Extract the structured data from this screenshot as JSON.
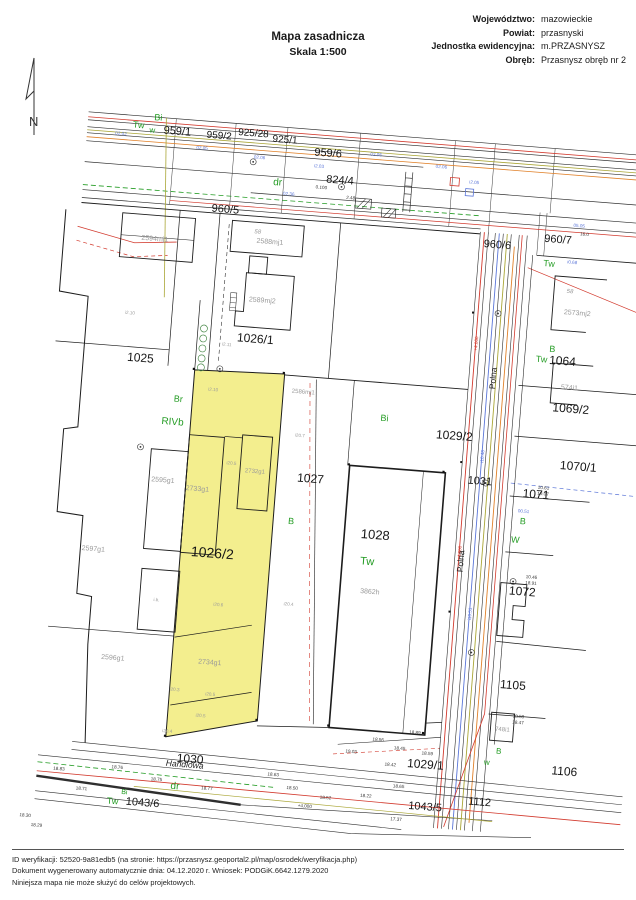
{
  "header": {
    "title": "Mapa zasadnicza",
    "scale": "Skala 1:500"
  },
  "meta": {
    "rows": [
      {
        "label": "Województwo:",
        "value": "mazowieckie"
      },
      {
        "label": "Powiat:",
        "value": "przasnyski"
      },
      {
        "label": "Jednostka ewidencyjna:",
        "value": "m.PRZASNYSZ"
      },
      {
        "label": "Obręb:",
        "value": "Przasnysz obręb nr 2"
      }
    ]
  },
  "compass": {
    "label": "N"
  },
  "footer": {
    "lines": [
      "ID weryfikacji: 52520-9a81edb5 (na stronie: https://przasnysz.geoportal2.pl/map/osrodek/weryfikacja.php)",
      "Dokument wygenerowany automatycznie dnia: 04.12.2020 r.   Wniosek: PODGiK.6642.1279.2020",
      "Niniejsza mapa nie może służyć do celów projektowych."
    ]
  },
  "map": {
    "colors": {
      "highlight": "#f3ee8e",
      "green": "#249c24",
      "blue": "#5b76d8",
      "red": "#d23a2e",
      "orange": "#e0812a",
      "olive": "#aaa636",
      "gray": "#9a9a9a",
      "black": "#333333"
    },
    "parcel_labels": [
      {
        "t": "959/1",
        "x": 152,
        "y": 143,
        "s": 11
      },
      {
        "t": "959/2",
        "x": 194,
        "y": 144,
        "s": 10
      },
      {
        "t": "925/28",
        "x": 228,
        "y": 139,
        "s": 10
      },
      {
        "t": "925/1",
        "x": 260,
        "y": 143,
        "s": 10
      },
      {
        "t": "959/6",
        "x": 304,
        "y": 153,
        "s": 11
      },
      {
        "t": "824/4",
        "x": 318,
        "y": 179,
        "s": 11
      },
      {
        "t": "960/5",
        "x": 206,
        "y": 217,
        "s": 11
      },
      {
        "t": "960/6",
        "x": 480,
        "y": 231,
        "s": 11
      },
      {
        "t": "960/7",
        "x": 540,
        "y": 221,
        "s": 11
      },
      {
        "t": "1025",
        "x": 133,
        "y": 372,
        "s": 12
      },
      {
        "t": "1026/1",
        "x": 246,
        "y": 344,
        "s": 12
      },
      {
        "t": "1026/2",
        "x": 220,
        "y": 561,
        "s": 14
      },
      {
        "t": "1027",
        "x": 312,
        "y": 479,
        "s": 12
      },
      {
        "t": "1028",
        "x": 381,
        "y": 530,
        "s": 13
      },
      {
        "t": "1064",
        "x": 554,
        "y": 342,
        "s": 12
      },
      {
        "t": "1069/2",
        "x": 566,
        "y": 389,
        "s": 12
      },
      {
        "t": "1029/2",
        "x": 452,
        "y": 425,
        "s": 12
      },
      {
        "t": "1070/1",
        "x": 578,
        "y": 446,
        "s": 12
      },
      {
        "t": "1031",
        "x": 481,
        "y": 468,
        "s": 11
      },
      {
        "t": "1071",
        "x": 538,
        "y": 477,
        "s": 12
      },
      {
        "t": "1072",
        "x": 532,
        "y": 575,
        "s": 12
      },
      {
        "t": "1105",
        "x": 530,
        "y": 669,
        "s": 12
      },
      {
        "t": "1106",
        "x": 588,
        "y": 751,
        "s": 12
      },
      {
        "t": "1029/1",
        "x": 449,
        "y": 755,
        "s": 12
      },
      {
        "t": "1030",
        "x": 214,
        "y": 768,
        "s": 12
      },
      {
        "t": "1043/6",
        "x": 170,
        "y": 815,
        "s": 11
      },
      {
        "t": "1043/5",
        "x": 452,
        "y": 797,
        "s": 11
      },
      {
        "t": "1112",
        "x": 506,
        "y": 788,
        "s": 11
      }
    ],
    "landuse_labels": [
      {
        "t": "Bi",
        "x": 132,
        "y": 131
      },
      {
        "t": "Tw",
        "x": 113,
        "y": 140
      },
      {
        "t": "w",
        "x": 127,
        "y": 144,
        "s": 8
      },
      {
        "t": "dr",
        "x": 256,
        "y": 186,
        "s": 10
      },
      {
        "t": "Tw",
        "x": 533,
        "y": 246
      },
      {
        "t": "Br",
        "x": 174,
        "y": 410
      },
      {
        "t": "RIVb",
        "x": 170,
        "y": 433,
        "s": 10
      },
      {
        "t": "Bi",
        "x": 381,
        "y": 413
      },
      {
        "t": "B",
        "x": 296,
        "y": 523
      },
      {
        "t": "Tw",
        "x": 375,
        "y": 557,
        "s": 11
      },
      {
        "t": "B",
        "x": 543,
        "y": 331
      },
      {
        "t": "Tw",
        "x": 533,
        "y": 342
      },
      {
        "t": "B",
        "x": 527,
        "y": 505
      },
      {
        "t": "W",
        "x": 521,
        "y": 524
      },
      {
        "t": "B",
        "x": 521,
        "y": 736,
        "s": 8
      },
      {
        "t": "w",
        "x": 510,
        "y": 748,
        "s": 8
      },
      {
        "t": "dr",
        "x": 201,
        "y": 796,
        "s": 10
      },
      {
        "t": "Bi",
        "x": 151,
        "y": 806,
        "s": 7
      },
      {
        "t": "Tw",
        "x": 140,
        "y": 816
      }
    ],
    "building_labels": [
      {
        "t": "2594mj1",
        "x": 138,
        "y": 252
      },
      {
        "t": "2588mj1",
        "x": 253,
        "y": 246
      },
      {
        "t": "2589mj2",
        "x": 250,
        "y": 305
      },
      {
        "t": "2586mj1",
        "x": 298,
        "y": 393,
        "s": 6
      },
      {
        "t": "2595g1",
        "x": 165,
        "y": 492
      },
      {
        "t": "2733g1",
        "x": 200,
        "y": 498
      },
      {
        "t": "2732g1",
        "x": 256,
        "y": 476,
        "s": 6
      },
      {
        "t": "2597g1",
        "x": 101,
        "y": 566
      },
      {
        "t": "2596g1",
        "x": 129,
        "y": 673
      },
      {
        "t": "2734g1",
        "x": 226,
        "y": 670
      },
      {
        "t": "3862h",
        "x": 380,
        "y": 587
      },
      {
        "t": "2573mj2",
        "x": 565,
        "y": 293
      },
      {
        "t": "574i1",
        "x": 563,
        "y": 368
      },
      {
        "t": "748i1",
        "x": 523,
        "y": 714,
        "s": 6
      }
    ],
    "street_labels": [
      {
        "t": "Polna",
        "x": 489,
        "y": 362,
        "rot": -90,
        "s": 8.5
      },
      {
        "t": "Polna",
        "x": 471,
        "y": 547,
        "rot": -90,
        "s": 8.5
      },
      {
        "t": "Handlowa",
        "x": 209,
        "y": 774,
        "italic": true,
        "s": 8.5
      }
    ],
    "micro_labels": [
      {
        "t": "02.02",
        "x": 96,
        "y": 150,
        "c": "blue"
      },
      {
        "t": "02.05",
        "x": 178,
        "y": 158,
        "c": "blue"
      },
      {
        "t": "02.06",
        "x": 236,
        "y": 163,
        "c": "blue"
      },
      {
        "t": "i2.03",
        "x": 296,
        "y": 167,
        "c": "blue"
      },
      {
        "t": "02.05",
        "x": 352,
        "y": 151,
        "c": "blue"
      },
      {
        "t": "02.06",
        "x": 418,
        "y": 158,
        "c": "blue"
      },
      {
        "t": "i2.05",
        "x": 452,
        "y": 171,
        "c": "blue"
      },
      {
        "t": "05.05",
        "x": 560,
        "y": 206,
        "c": "blue"
      },
      {
        "t": "16.0",
        "x": 566,
        "y": 214,
        "c": "black"
      },
      {
        "t": "02.36",
        "x": 268,
        "y": 197,
        "c": "blue"
      },
      {
        "t": "2.48",
        "x": 330,
        "y": 196,
        "c": "black"
      },
      {
        "t": "0.100",
        "x": 300,
        "y": 188,
        "c": "black"
      },
      {
        "t": "i2.11",
        "x": 218,
        "y": 352,
        "c": "gray"
      },
      {
        "t": "i2.10",
        "x": 208,
        "y": 398,
        "c": "gray"
      },
      {
        "t": "i2.10",
        "x": 119,
        "y": 328,
        "c": "gray"
      },
      {
        "t": "i20.5",
        "x": 232,
        "y": 470,
        "c": "gray"
      },
      {
        "t": "i20.7",
        "x": 298,
        "y": 437,
        "c": "gray"
      },
      {
        "t": "i20.6",
        "x": 230,
        "y": 612,
        "c": "gray"
      },
      {
        "t": "i20.4",
        "x": 300,
        "y": 606,
        "c": "gray"
      },
      {
        "t": "i20.3",
        "x": 193,
        "y": 700,
        "c": "gray"
      },
      {
        "t": "i20.5",
        "x": 229,
        "y": 702,
        "c": "gray"
      },
      {
        "t": "i20.5",
        "x": 221,
        "y": 724,
        "c": "gray"
      },
      {
        "t": "i20.4",
        "x": 189,
        "y": 742,
        "c": "gray"
      },
      {
        "t": "i.b.",
        "x": 168,
        "y": 612,
        "c": "gray"
      },
      {
        "t": "58",
        "x": 240,
        "y": 237,
        "c": "gray",
        "italic": true,
        "s": 6
      },
      {
        "t": "58",
        "x": 556,
        "y": 272,
        "c": "gray",
        "italic": true,
        "s": 6
      },
      {
        "t": "i0.68",
        "x": 556,
        "y": 243,
        "c": "blue"
      },
      {
        "t": "00.51",
        "x": 527,
        "y": 495,
        "c": "blue"
      },
      {
        "t": "i10.48",
        "x": 483,
        "y": 442,
        "c": "blue",
        "rot": -90
      },
      {
        "t": "i10.51",
        "x": 483,
        "y": 600,
        "c": "blue",
        "rot": -90
      },
      {
        "t": "+4.000",
        "x": 468,
        "y": 540,
        "c": "red",
        "rot": -90
      },
      {
        "t": "+4.000",
        "x": 468,
        "y": 330,
        "c": "red",
        "rot": -90
      },
      {
        "t": "10.61",
        "x": 545,
        "y": 470,
        "c": "black"
      },
      {
        "t": "19.07",
        "x": 545,
        "y": 476,
        "c": "black"
      },
      {
        "t": "10.46",
        "x": 540,
        "y": 560,
        "c": "black"
      },
      {
        "t": "18.91",
        "x": 540,
        "y": 566,
        "c": "black"
      },
      {
        "t": "18.50",
        "x": 538,
        "y": 700,
        "c": "black"
      },
      {
        "t": "18.47",
        "x": 538,
        "y": 706,
        "c": "black"
      },
      {
        "t": "18.83",
        "x": 84,
        "y": 788,
        "c": "black"
      },
      {
        "t": "18.76",
        "x": 142,
        "y": 782,
        "c": "black"
      },
      {
        "t": "18.75",
        "x": 182,
        "y": 791,
        "c": "black"
      },
      {
        "t": "18.71",
        "x": 108,
        "y": 806,
        "c": "black"
      },
      {
        "t": "18.77",
        "x": 233,
        "y": 796,
        "c": "black"
      },
      {
        "t": "18.63",
        "x": 298,
        "y": 777,
        "c": "black"
      },
      {
        "t": "18.50",
        "x": 318,
        "y": 789,
        "c": "black"
      },
      {
        "t": "18.52",
        "x": 352,
        "y": 796,
        "c": "black"
      },
      {
        "t": "18.22",
        "x": 392,
        "y": 791,
        "c": "black"
      },
      {
        "t": "18.65",
        "x": 424,
        "y": 779,
        "c": "black"
      },
      {
        "t": "18.42",
        "x": 414,
        "y": 758,
        "c": "black"
      },
      {
        "t": "17.37",
        "x": 424,
        "y": 812,
        "c": "black"
      },
      {
        "t": "+4.000",
        "x": 332,
        "y": 806,
        "c": "black"
      },
      {
        "t": "18.56",
        "x": 400,
        "y": 734,
        "c": "black"
      },
      {
        "t": "18.45",
        "x": 422,
        "y": 741,
        "c": "black"
      },
      {
        "t": "19.03",
        "x": 374,
        "y": 748,
        "c": "black"
      },
      {
        "t": "18.59",
        "x": 450,
        "y": 744,
        "c": "black"
      },
      {
        "t": "18.89",
        "x": 436,
        "y": 724,
        "c": "black"
      },
      {
        "t": "18.30",
        "x": 54,
        "y": 837,
        "c": "black"
      },
      {
        "t": "18.29",
        "x": 66,
        "y": 846,
        "c": "black"
      }
    ]
  }
}
